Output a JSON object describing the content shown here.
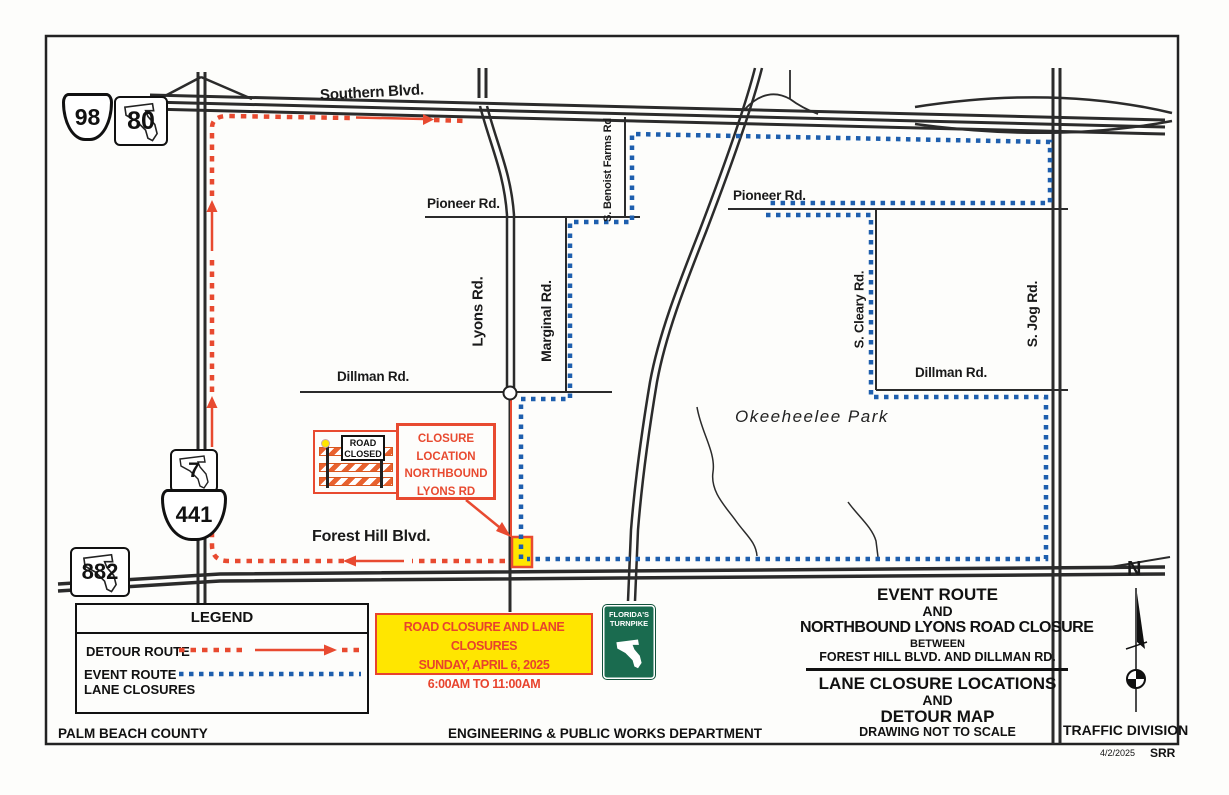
{
  "colors": {
    "detour_red": "#e84a30",
    "event_blue": "#1e5fae",
    "closure_yellow": "#ffe600",
    "turnpike_green": "#1a6b4f"
  },
  "map": {
    "roads": {
      "southern": "Southern Blvd.",
      "pioneer_west": "Pioneer Rd.",
      "pioneer_east": "Pioneer Rd.",
      "lyons": "Lyons Rd.",
      "marginal": "Marginal Rd.",
      "benoist": "S. Benoist Farms Rd",
      "cleary": "S. Cleary Rd.",
      "jog": "S. Jog Rd.",
      "dillman_west": "Dillman Rd.",
      "dillman_east": "Dillman Rd.",
      "forest_hill": "Forest Hill Blvd.",
      "park": "Okeeheelee Park"
    },
    "shields": {
      "us98": "98",
      "sr80": "80",
      "sr7": "7",
      "us441": "441",
      "sr882": "882"
    },
    "north_label": "N"
  },
  "road_closed_sign": {
    "line1": "ROAD",
    "line2": "CLOSED"
  },
  "closure_callout": {
    "line1": "CLOSURE",
    "line2": "LOCATION",
    "line3": "NORTHBOUND",
    "line4": "LYONS RD"
  },
  "announcement": {
    "line1": "ROAD CLOSURE AND LANE CLOSURES",
    "line2": "SUNDAY, APRIL 6, 2025",
    "line3": "6:00AM TO 11:00AM"
  },
  "turnpike_sign": {
    "line1": "FLORIDA'S",
    "line2": "TURNPIKE"
  },
  "legend": {
    "title": "LEGEND",
    "detour_label": "DETOUR ROUTE",
    "event_label_line1": "EVENT ROUTE",
    "event_label_line2": "LANE CLOSURES"
  },
  "title_block": {
    "l1": "EVENT ROUTE",
    "l2": "AND",
    "l3": "NORTHBOUND LYONS ROAD CLOSURE",
    "l4": "BETWEEN",
    "l5": "FOREST HILL  BLVD. AND DILLMAN RD.",
    "l6": "LANE CLOSURE LOCATIONS",
    "l7": "AND",
    "l8": "DETOUR MAP",
    "l9": "DRAWING NOT TO SCALE"
  },
  "footer": {
    "left": "PALM BEACH COUNTY",
    "center": "ENGINEERING & PUBLIC WORKS DEPARTMENT",
    "right": "TRAFFIC DIVISION",
    "date": "4/2/2025",
    "initials": "SRR"
  }
}
